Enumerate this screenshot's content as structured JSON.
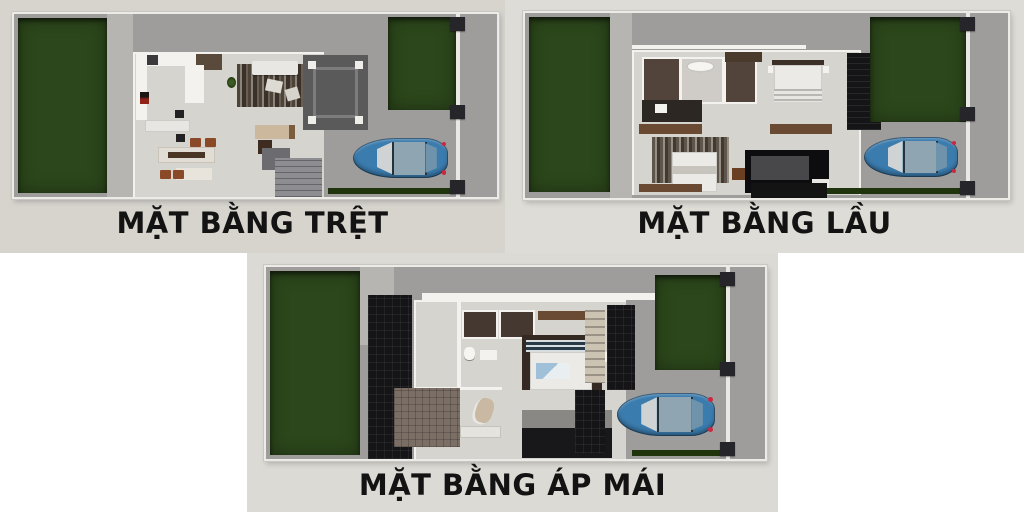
{
  "page": {
    "background": "#ffffff"
  },
  "panels": [
    {
      "id": "ground-floor",
      "label": "MẶT BẰNG TRỆT"
    },
    {
      "id": "upper-floor",
      "label": "MẶT BẰNG LẦU"
    },
    {
      "id": "attic-floor",
      "label": "MẶT BẰNG ÁP MÁI"
    }
  ],
  "colors": {
    "card_bg_1": "#d7d4ce",
    "card_bg_2": "#dedcd6",
    "card_bg_3": "#dcdad4",
    "label_text": "#131313",
    "lawn_green": "#2c471b",
    "hedge_green": "#1f330d",
    "pavement": "#9e9d9b",
    "walkway": "#b7b5b1",
    "floor": "#d6d4cf",
    "wall_white": "#f3f2ef",
    "patio_dark": "#595a59",
    "roof_dark": "#151518",
    "wood_brown": "#6b4a33",
    "closet_brown": "#52443a",
    "roof_brown": "#7b6e65",
    "car_blue": "#3b7cae",
    "fence_post": "#26262a"
  }
}
